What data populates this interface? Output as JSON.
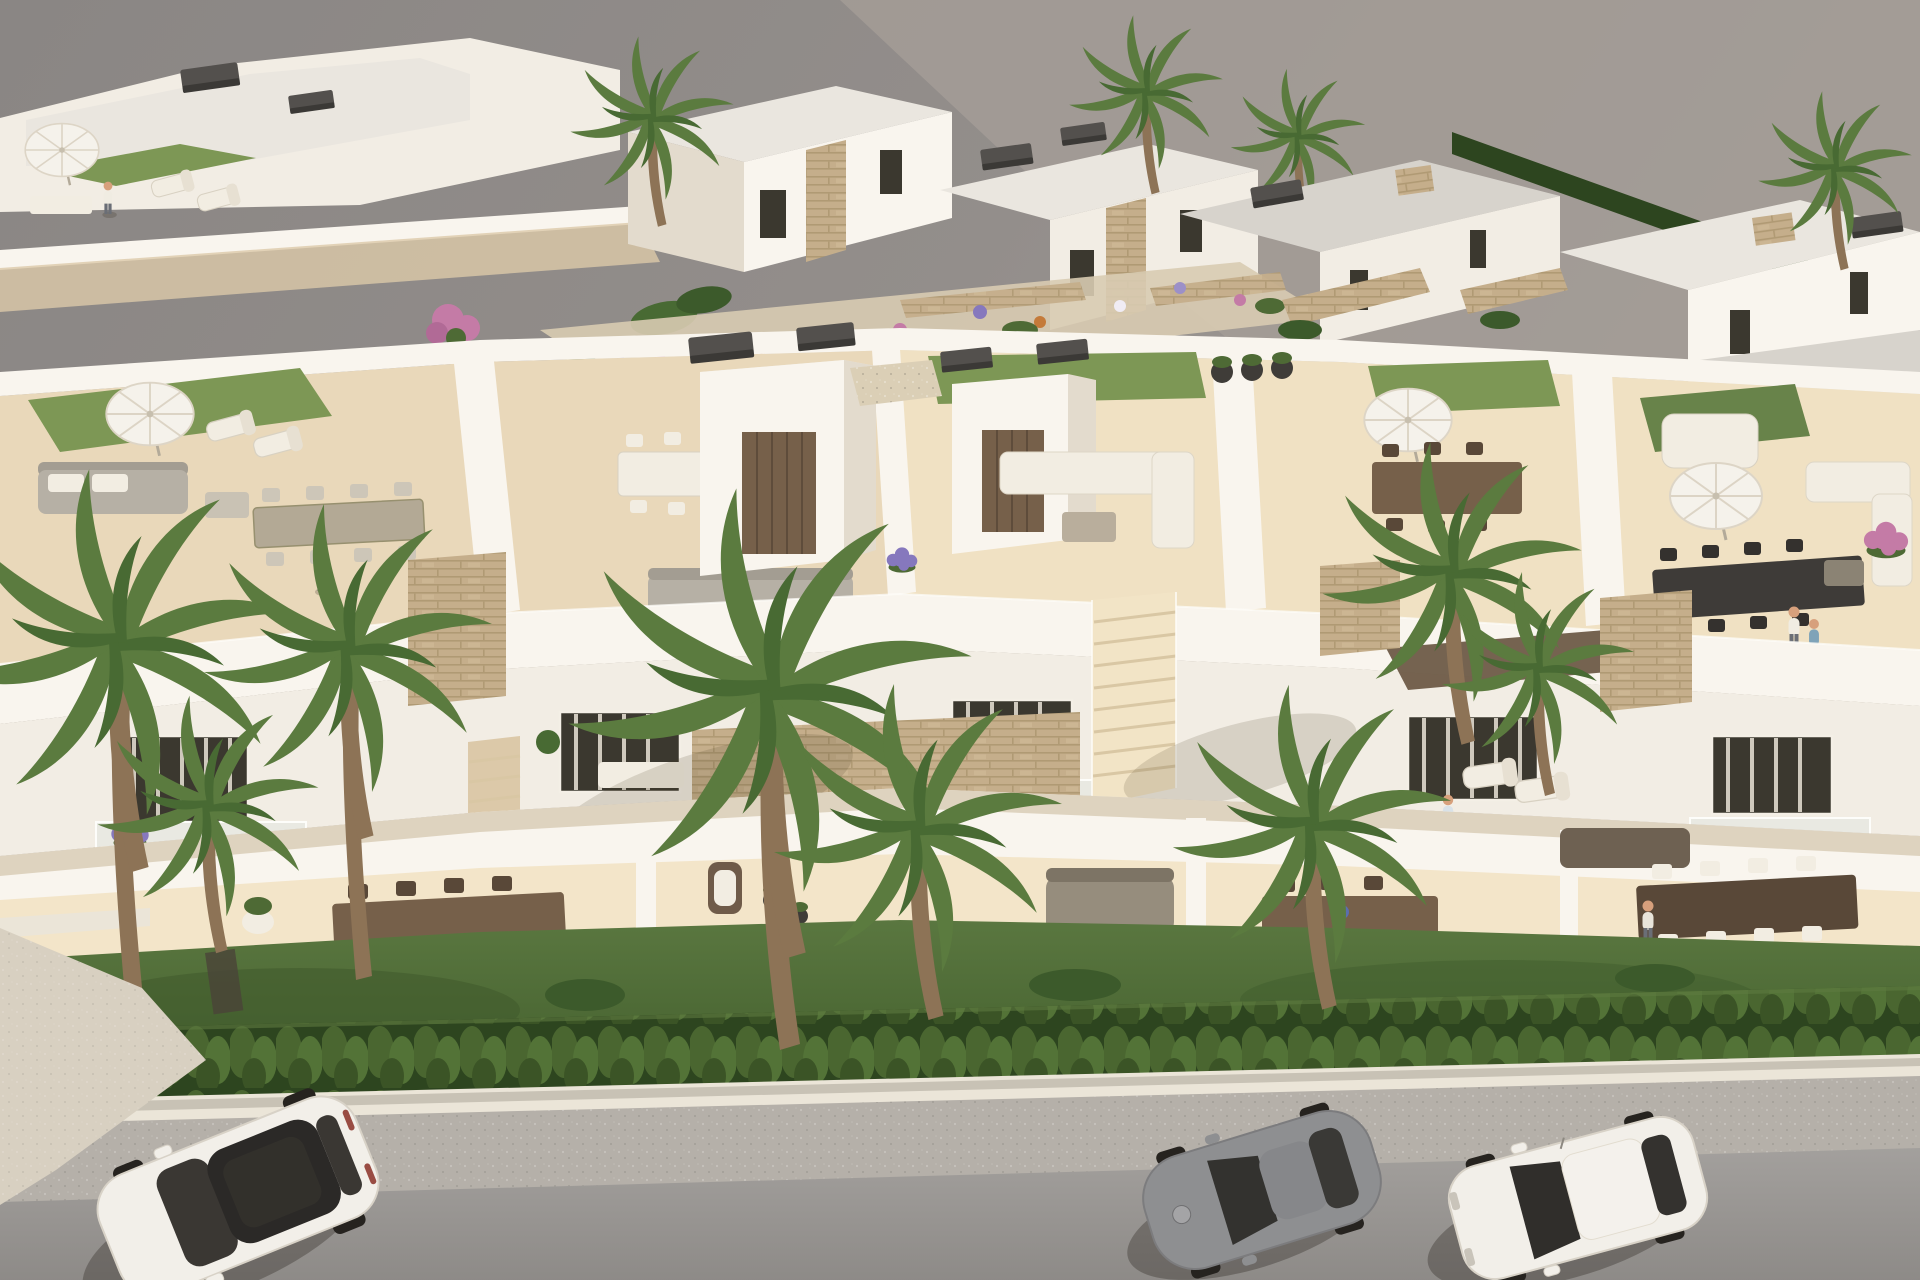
{
  "meta": {
    "type": "3d-architectural-rendering",
    "view": "aerial-oblique",
    "width": 1920,
    "height": 1280
  },
  "scene": {
    "subject": "aerial view of a modern white Mediterranean residential development with rooftop terraces",
    "background": "rows of white flat-roofed villas with stone accents, gardens and palm trees under a gray backdrop",
    "midground": "townhouse block with roof decks: artificial grass patches, parasols, lounge sofas, dining tables, stairwell boxes with dark caps",
    "foreground": "balconies with flower boxes, stone-clad panels, ground terraces with wooden dining sets, lawn, cypress hedge, sidewalk and street",
    "rooftop_terraces": 5,
    "parasols": 5,
    "people_visible": 7,
    "palm_trees_foreground": 8,
    "cars": [
      {
        "id": "white-suv",
        "body": "#f2efe9",
        "glass": "#2b2927"
      },
      {
        "id": "gray-sports-coupe",
        "body": "#8e8f91",
        "glass": "#33322f"
      },
      {
        "id": "white-sedan",
        "body": "#f2efe9",
        "glass": "#302e2b"
      }
    ]
  },
  "palette": {
    "sky": "#8c8885",
    "ground_far": "#a39c96",
    "wall_white": "#f2ede4",
    "wall_sunlit": "#f9f5ee",
    "wall_shade": "#e3dbcd",
    "wall_deep": "#cfc4b1",
    "roof_light": "#eae6df",
    "roof_gray": "#d7d3cc",
    "floor_terrace": "#e9d8ba",
    "floor_sun": "#f2e4c6",
    "floor_shade": "#dcc9a9",
    "grass_roof": "#7d9755",
    "grass_roof_dark": "#68834a",
    "lawn": "#52703a",
    "lawn_dark": "#3f5a2c",
    "hedge": "#47622f",
    "hedge_dark": "#2d451f",
    "stone": "#c5ae8b",
    "cap": "#514e4b",
    "curb": "#ebe5d8",
    "sidewalk": "#b5b0a9",
    "asphalt": "#9a9794",
    "driveway": "#d8d0c1",
    "umbrella": "#f5f2eb",
    "wood": "#76604a",
    "wood_dark": "#594838",
    "table_dark": "#3e3b38",
    "sofa_gray": "#b6b0a5",
    "cushion": "#f2ede2",
    "car_white": "#f2efe9",
    "car_gray": "#8e8f91",
    "glass_dark": "#2b2927",
    "wheel": "#26231f",
    "gravel": "#dbcfb6",
    "pergola_wood": "#6e5b47",
    "flower_purple": "#8678bd",
    "flower_lavender": "#9c90c8",
    "flower_pink": "#c47ba6",
    "flower_red": "#b5492f",
    "flower_white": "#f0ecf4",
    "flower_orange": "#c47a3a",
    "flower_blue": "#5b6eb0",
    "shadow": "rgba(45,40,34,0.35)"
  }
}
